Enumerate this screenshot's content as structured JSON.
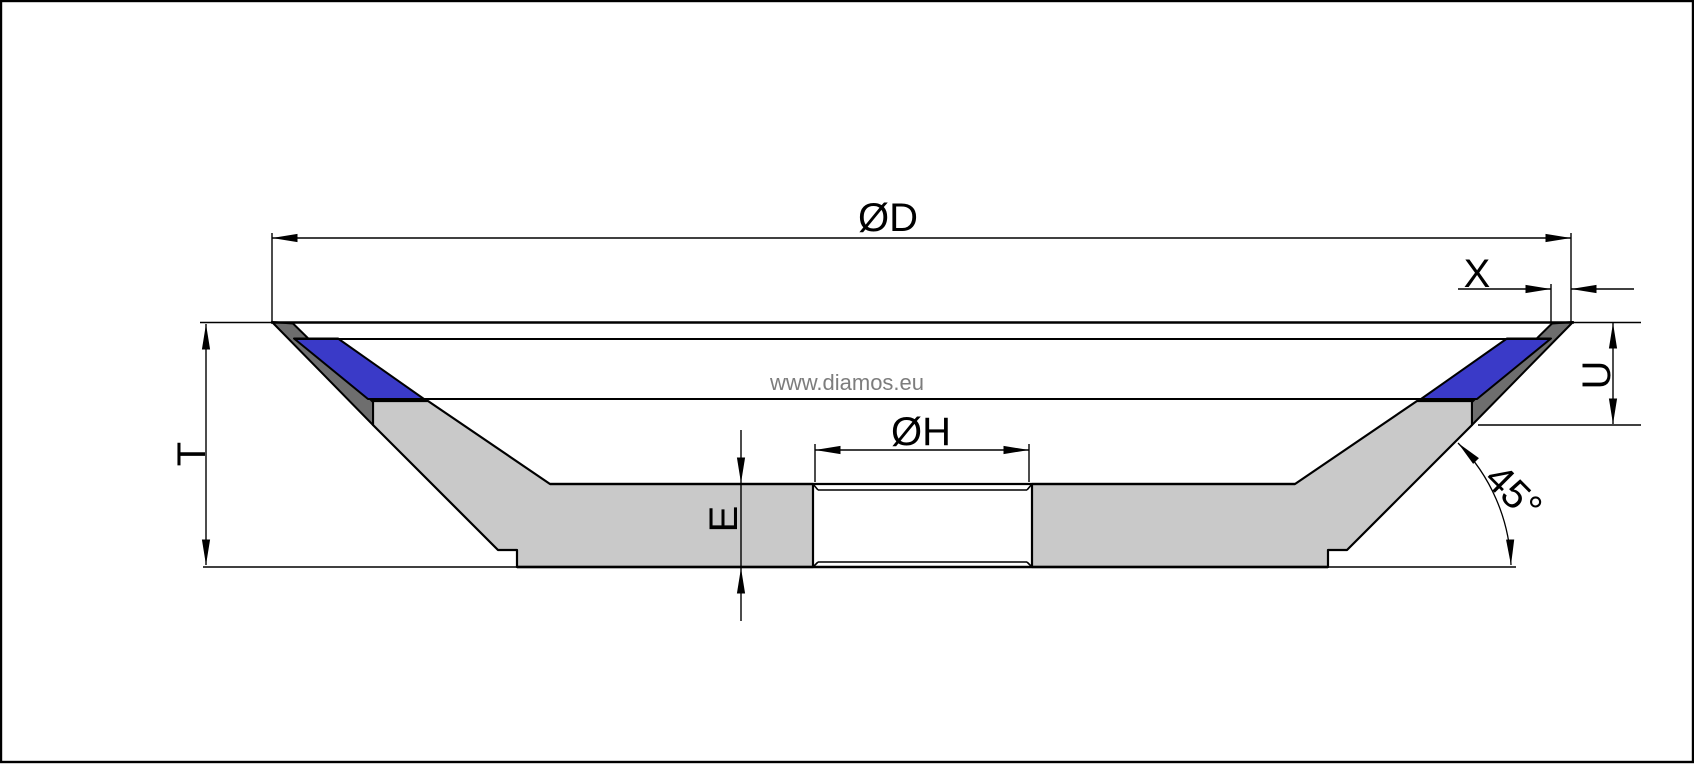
{
  "drawing": {
    "type": "grinding-wheel-cross-section",
    "watermark": "www.diamos.eu",
    "labels": {
      "d": "ØD",
      "x": "X",
      "u": "U",
      "t": "T",
      "e": "E",
      "h": "ØH",
      "angle": "45°"
    },
    "colors": {
      "background": "#ffffff",
      "line": "#000000",
      "body_gray": "#c9c9c9",
      "bevel_gray": "#6e6e6e",
      "segment_blue": "#3a3ac8",
      "watermark_gray": "#7d7d7d",
      "border": "#000000"
    }
  }
}
